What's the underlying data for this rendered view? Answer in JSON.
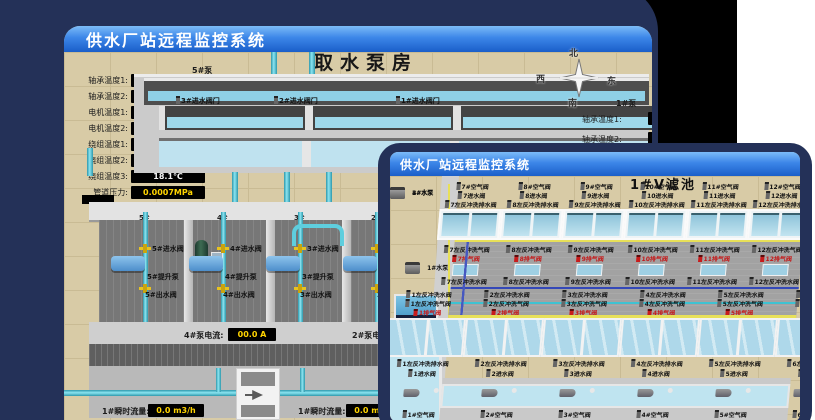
{
  "colors": {
    "window_frame": "#243158",
    "titlebar_top": "#7cbcf8",
    "titlebar_bottom": "#1a5ec9",
    "floor_tan": "#d8cba6",
    "value_yellow": "#ffd400",
    "pipe_cyan": "#4fc3d8",
    "water_blue": "#aed8ea",
    "alarm_red": "#c81c1c"
  },
  "back_window": {
    "title": "供水厂站远程监控系统",
    "heading": "取水泵房",
    "pump_group_label": "5#泵",
    "sensors": [
      {
        "label": "轴承温度1:",
        "value": "100.0℃"
      },
      {
        "label": "轴承温度2:",
        "value": "100.0℃"
      },
      {
        "label": "电机温度1:",
        "value": "18.1℃"
      },
      {
        "label": "电机温度2:",
        "value": "17.9℃"
      },
      {
        "label": "绕组温度1:",
        "value": "18.0℃"
      },
      {
        "label": "绕组温度2:",
        "value": "18.1℃"
      },
      {
        "label": "绕组温度3:",
        "value": "18.1℃"
      },
      {
        "label": "管道压力:",
        "value": "0.0007MPa"
      },
      {
        "label": "多功能阀:",
        "value": "0%"
      }
    ],
    "intake_valves": [
      "3#进水阀门",
      "2#进水阀门",
      "1#进水阀门"
    ],
    "pump_bays": [
      {
        "no": "5#",
        "inlet": "5#进水阀",
        "pump": "5#提升泵",
        "outlet": "5#出水阀"
      },
      {
        "no": "4#",
        "inlet": "4#进水阀",
        "pump": "4#提升泵",
        "outlet": "4#出水阀"
      },
      {
        "no": "3#",
        "inlet": "3#进水阀",
        "pump": "3#提升泵",
        "outlet": "3#出水阀"
      },
      {
        "no": "2#",
        "inlet": "2#进水阀",
        "pump": "2#提升泵",
        "outlet": "2#出水阀"
      }
    ],
    "current_left": {
      "label": "4#泵电流:",
      "value": "00.0 A"
    },
    "current_right": {
      "label": "2#泵电流:"
    },
    "flow_left": {
      "label": "1#瞬时流量:",
      "value": "0.0 m3/h"
    },
    "flow_right": {
      "label": "1#瞬时流量:",
      "value": "0.0 m3/h"
    },
    "compass": {
      "n": "北",
      "w": "西",
      "e": "东",
      "s": "南"
    },
    "edge_labels": {
      "pump": "1#泵",
      "t1": "轴承温度1:",
      "t2": "轴承温度2:"
    }
  },
  "front_window": {
    "title": "供水厂站远程监控系统",
    "heading": "1#V滤池",
    "left_equipment": [
      "1#水泵",
      "2#水泵",
      "3#水泵",
      "4#水泵"
    ],
    "top_cells": [
      {
        "air": "7#空气阀",
        "inlet": "7进水阀",
        "drain": "7左反冲洗排水阀",
        "gas": "7左反冲洗气阀",
        "vent": "7排气阀",
        "wash": "7左反冲洗水阀"
      },
      {
        "air": "8#空气阀",
        "inlet": "8进水阀",
        "drain": "8左反冲洗排水阀",
        "gas": "8左反冲洗气阀",
        "vent": "8排气阀",
        "wash": "8左反冲洗水阀"
      },
      {
        "air": "9#空气阀",
        "inlet": "9进水阀",
        "drain": "9左反冲洗排水阀",
        "gas": "9左反冲洗气阀",
        "vent": "9排气阀",
        "wash": "9左反冲洗水阀"
      },
      {
        "air": "10#空气阀",
        "inlet": "10进水阀",
        "drain": "10左反冲洗排水阀",
        "gas": "10左反冲洗气阀",
        "vent": "10排气阀",
        "wash": "10左反冲洗水阀"
      },
      {
        "air": "11#空气阀",
        "inlet": "11进水阀",
        "drain": "11左反冲洗排水阀",
        "gas": "11左反冲洗气阀",
        "vent": "11排气阀",
        "wash": "11左反冲洗水阀"
      },
      {
        "air": "12#空气阀",
        "inlet": "12进水阀",
        "drain": "12左反冲洗排水阀",
        "gas": "12左反冲洗气阀",
        "vent": "12排气阀",
        "wash": "12左反冲洗水阀"
      }
    ],
    "bottom_cells": [
      {
        "wash": "1左反冲洗水阀",
        "gas": "1左反冲洗气阀",
        "vent": "1排气阀",
        "drain": "1左反冲洗排水阀",
        "inlet": "1进水阀",
        "air": "1#空气阀"
      },
      {
        "wash": "2左反冲洗水阀",
        "gas": "2左反冲洗气阀",
        "vent": "2排气阀",
        "drain": "2左反冲洗排水阀",
        "inlet": "2进水阀",
        "air": "2#空气阀"
      },
      {
        "wash": "3左反冲洗水阀",
        "gas": "3左反冲洗气阀",
        "vent": "3排气阀",
        "drain": "3左反冲洗排水阀",
        "inlet": "3进水阀",
        "air": "3#空气阀"
      },
      {
        "wash": "4左反冲洗水阀",
        "gas": "4左反冲洗气阀",
        "vent": "4排气阀",
        "drain": "4左反冲洗排水阀",
        "inlet": "4进水阀",
        "air": "4#空气阀"
      },
      {
        "wash": "5左反冲洗水阀",
        "gas": "5左反冲洗气阀",
        "vent": "5排气阀",
        "drain": "5左反冲洗排水阀",
        "inlet": "5进水阀",
        "air": "5#空气阀"
      },
      {
        "wash": "6左反冲洗水阀",
        "gas": "6左反冲洗气阀",
        "vent": "6排气阀",
        "drain": "6左反冲洗排水阀",
        "inlet": "6进水阀",
        "air": "6#空气阀"
      }
    ]
  }
}
